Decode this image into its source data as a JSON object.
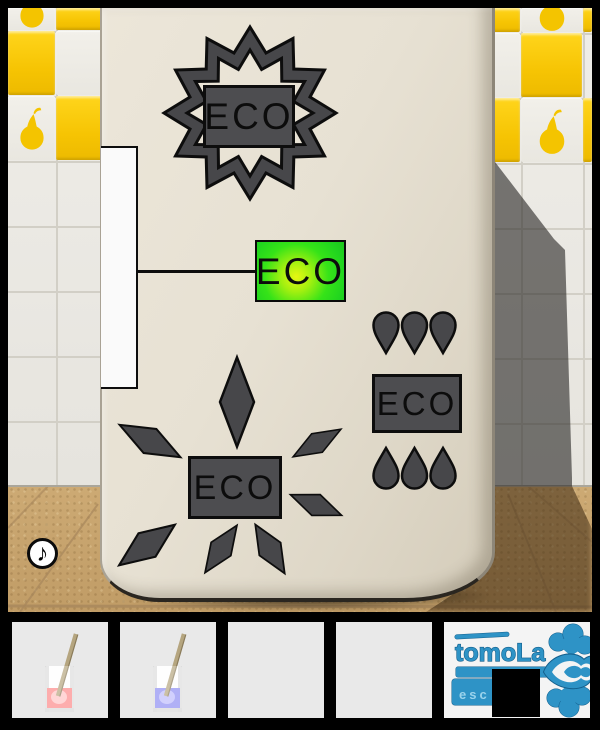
{
  "badges": {
    "star": {
      "label": "ECO",
      "decoration": "twelve-point-star-burst"
    },
    "glow": {
      "label": "ECO",
      "decoration": "green-glow"
    },
    "drops": {
      "label": "ECO",
      "decoration": "water-drops-above-and-below",
      "drops_top": 3,
      "drops_bottom": 3
    },
    "sun": {
      "label": "ECO",
      "decoration": "diamond-rays",
      "ray_count": 7
    }
  },
  "sound_button": {
    "symbol": "♪"
  },
  "inventory": {
    "slot1_item": "glass-with-red-liquid-and-stirrer",
    "slot2_item": "glass-with-blue-liquid-and-stirrer",
    "slot3_item": "empty",
    "slot4_item": "empty",
    "slot5_item": "tomola-logo",
    "logo": {
      "title": "tomoLa",
      "tag": "esc"
    }
  },
  "colors": {
    "glow_green": "#2be11f",
    "glow_center": "#e6f713",
    "tile_yellow": "#f6c403",
    "panel_gray": "#4d4d50",
    "logo_blue": "#2e93c6",
    "liquid_red": "#fc8a8a",
    "liquid_blue": "#8f8ef2",
    "door_cream": "#e7e1d3",
    "floor_tan": "#c6a26c"
  }
}
